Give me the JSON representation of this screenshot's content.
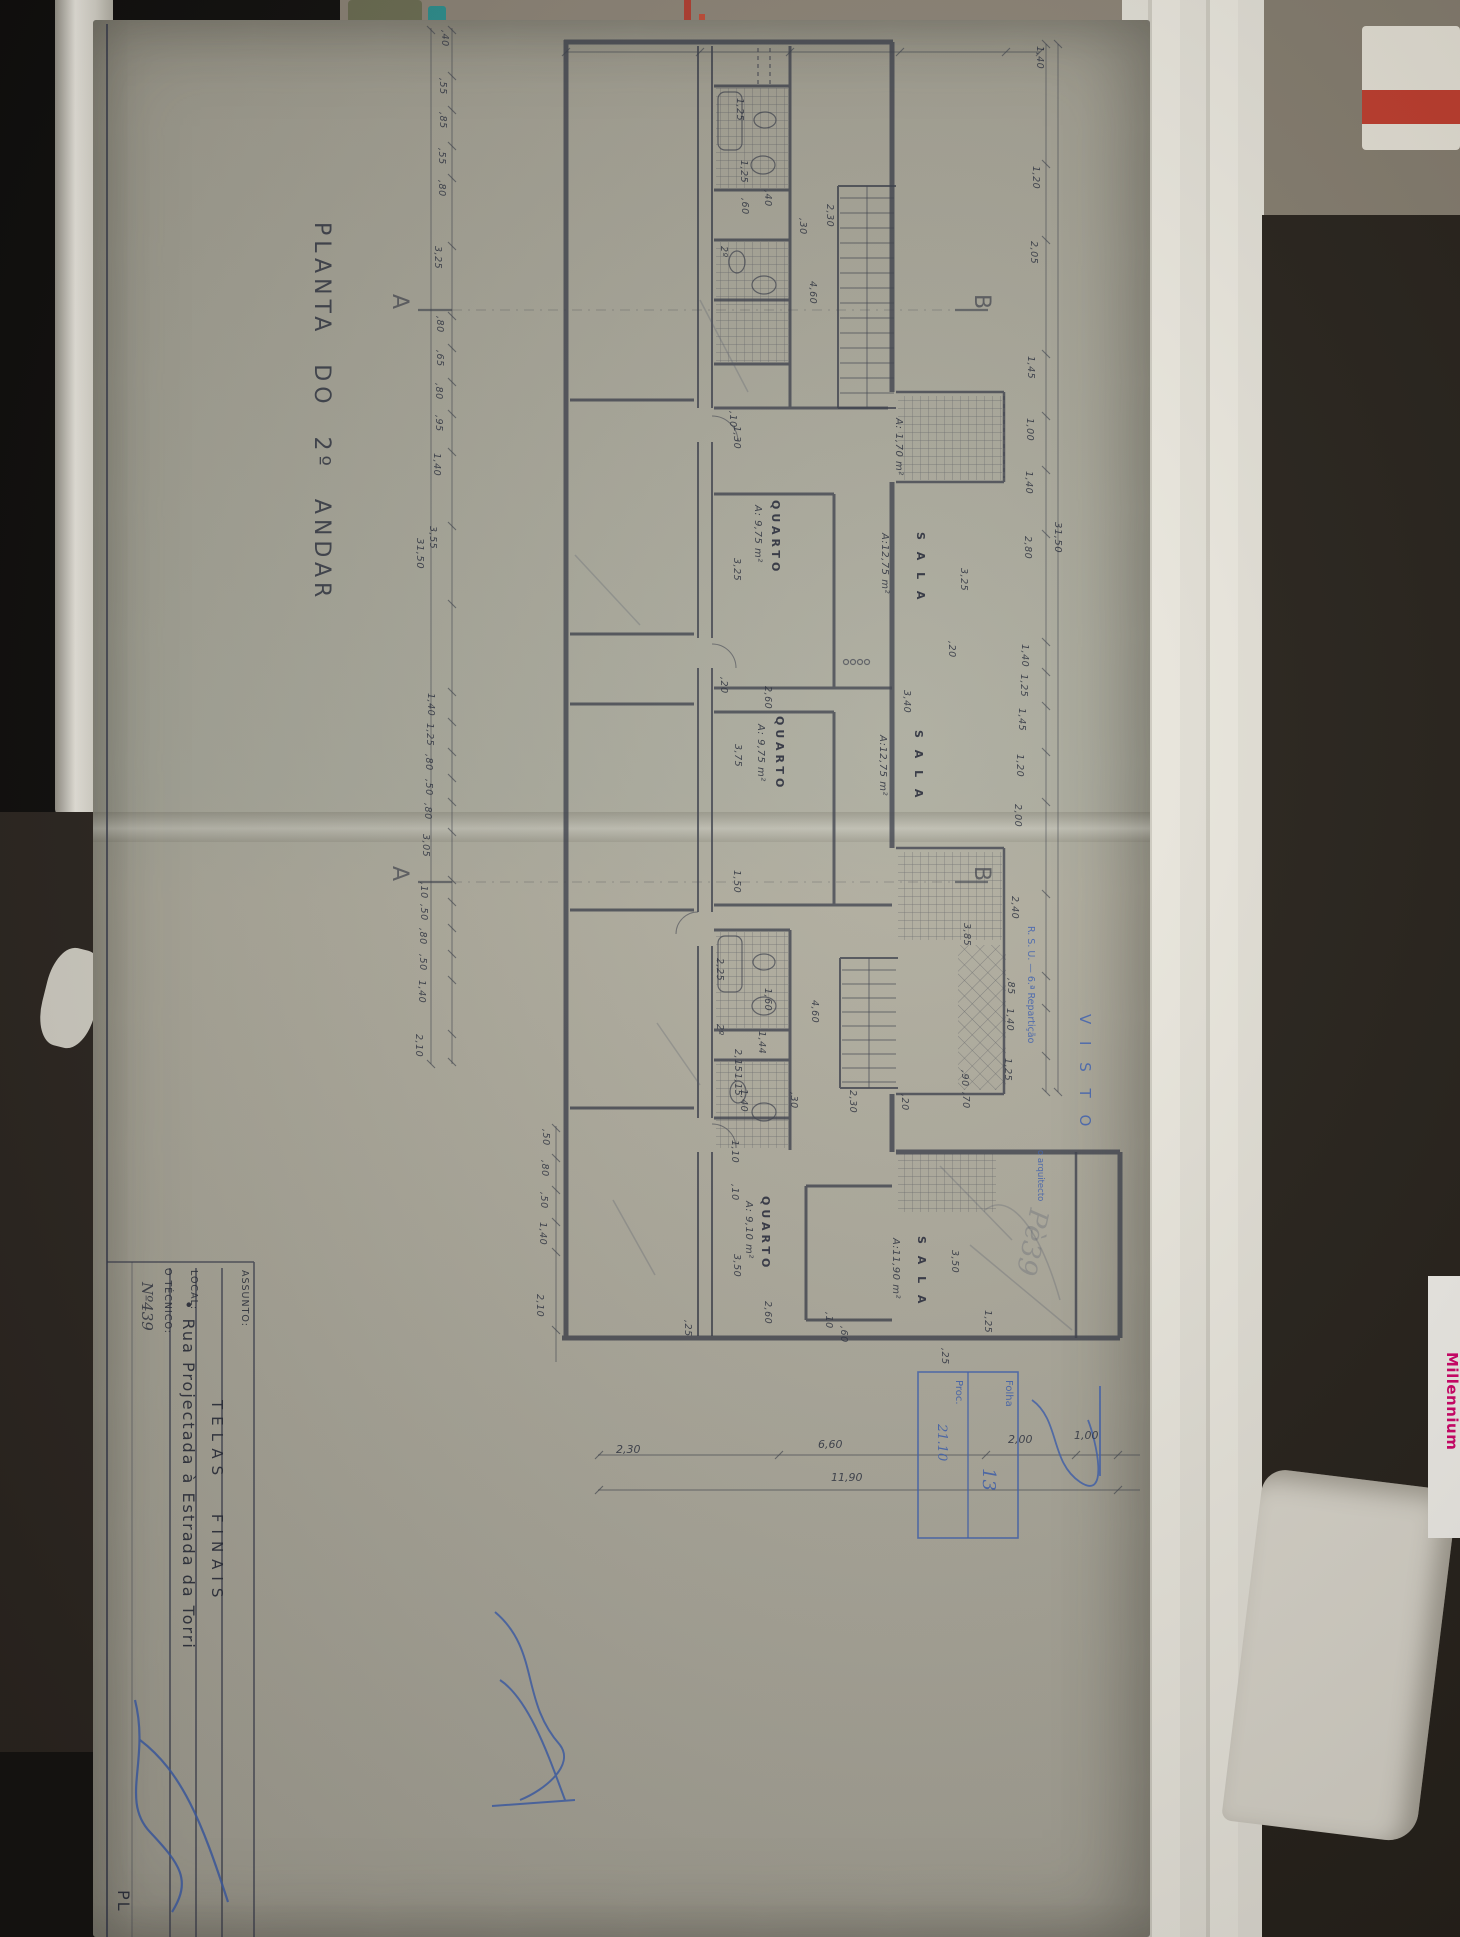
{
  "photo": {
    "millennium_text": "Millennium",
    "colors": {
      "paper": "#aba89b",
      "ink": "#3a3e4a",
      "stamp_blue": "#3f62ae",
      "brand_pink": "#d4006a"
    }
  },
  "drawing_title": "PLANTA DO 2º ANDAR",
  "title_block": {
    "assunto_label": "ASSUNTO:",
    "assunto_value": "TELAS FINAIS",
    "local_label": "LOCAL:",
    "local_value": "• Rua Projectada à Estrada da Torri",
    "tecnico_label": "O TÉCNICO:",
    "tecnico_value": "Nº439",
    "next_cell_partial": "PL"
  },
  "stamps": {
    "folha_label": "Folha",
    "folha_value": "13",
    "proc_label": "Proc.",
    "proc_value": "21.10",
    "visto_line1": "R. S. U. — 6.ª Repartição",
    "visto_line2": "V I S T O",
    "visto_line3": "o arquitecto",
    "pencil_note": "Pè39"
  },
  "plan": {
    "labels": [
      {
        "t": "QUARTO",
        "x": 781,
        "y": 500,
        "c": "room"
      },
      {
        "t": "A: 9,75 m²",
        "x": 762,
        "y": 505,
        "c": "area"
      },
      {
        "t": "S A L A",
        "x": 926,
        "y": 532,
        "c": "room"
      },
      {
        "t": "A:12,75 m²",
        "x": 889,
        "y": 533,
        "c": "area"
      },
      {
        "t": "QUARTO",
        "x": 785,
        "y": 716,
        "c": "room"
      },
      {
        "t": "A: 9,75 m²",
        "x": 765,
        "y": 724,
        "c": "area"
      },
      {
        "t": "S A L A",
        "x": 924,
        "y": 730,
        "c": "room"
      },
      {
        "t": "A:12,75 m²",
        "x": 887,
        "y": 735,
        "c": "area"
      },
      {
        "t": "QUARTO",
        "x": 771,
        "y": 1196,
        "c": "room"
      },
      {
        "t": "A: 9,10 m²",
        "x": 753,
        "y": 1201,
        "c": "area"
      },
      {
        "t": "S A L A",
        "x": 927,
        "y": 1236,
        "c": "room"
      },
      {
        "t": "A:11,90 m²",
        "x": 900,
        "y": 1238,
        "c": "area"
      },
      {
        "t": "A: 1,70 m²",
        "x": 903,
        "y": 418,
        "c": "area"
      },
      {
        "t": "A",
        "x": 410,
        "y": 294,
        "c": "sect"
      },
      {
        "t": "A",
        "x": 410,
        "y": 866,
        "c": "sect"
      },
      {
        "t": "B",
        "x": 992,
        "y": 294,
        "c": "sect"
      },
      {
        "t": "B",
        "x": 992,
        "y": 866,
        "c": "sect"
      },
      {
        "t": "1,25",
        "x": 744,
        "y": 98
      },
      {
        "t": ",60",
        "x": 749,
        "y": 198
      },
      {
        "t": ",40",
        "x": 772,
        "y": 190
      },
      {
        "t": "2º",
        "x": 728,
        "y": 246
      },
      {
        "t": "1,25",
        "x": 748,
        "y": 160
      },
      {
        "t": "2,30",
        "x": 834,
        "y": 204
      },
      {
        "t": ",30",
        "x": 807,
        "y": 218
      },
      {
        "t": "4,60",
        "x": 817,
        "y": 281
      },
      {
        "t": ",10",
        "x": 737,
        "y": 411
      },
      {
        "t": "1,30",
        "x": 741,
        "y": 426
      },
      {
        "t": "3,25",
        "x": 741,
        "y": 558
      },
      {
        "t": "2,60",
        "x": 772,
        "y": 686
      },
      {
        "t": ",20",
        "x": 728,
        "y": 677
      },
      {
        "t": "3,40",
        "x": 911,
        "y": 690
      },
      {
        "t": "3,25",
        "x": 968,
        "y": 568
      },
      {
        "t": ",20",
        "x": 956,
        "y": 641
      },
      {
        "t": "3,75",
        "x": 742,
        "y": 744
      },
      {
        "t": "1,50",
        "x": 741,
        "y": 870
      },
      {
        "t": "3,85",
        "x": 971,
        "y": 923
      },
      {
        "t": "2,25",
        "x": 724,
        "y": 958
      },
      {
        "t": "1,60",
        "x": 772,
        "y": 988
      },
      {
        "t": "1,44",
        "x": 766,
        "y": 1031
      },
      {
        "t": "2º",
        "x": 724,
        "y": 1024
      },
      {
        "t": "2,15",
        "x": 742,
        "y": 1049
      },
      {
        "t": "1,15",
        "x": 742,
        "y": 1073
      },
      {
        "t": "1,40",
        "x": 748,
        "y": 1089
      },
      {
        "t": "4,60",
        "x": 819,
        "y": 1000
      },
      {
        "t": "2,30",
        "x": 857,
        "y": 1090
      },
      {
        "t": ",30",
        "x": 798,
        "y": 1092
      },
      {
        "t": ",20",
        "x": 909,
        "y": 1094
      },
      {
        "t": ",90",
        "x": 969,
        "y": 1070
      },
      {
        "t": ",70",
        "x": 970,
        "y": 1092
      },
      {
        "t": "1,10",
        "x": 739,
        "y": 1140
      },
      {
        "t": ",10",
        "x": 739,
        "y": 1184
      },
      {
        "t": "3,50",
        "x": 741,
        "y": 1254
      },
      {
        "t": "2,60",
        "x": 772,
        "y": 1301
      },
      {
        "t": ",25",
        "x": 692,
        "y": 1320
      },
      {
        "t": ",10",
        "x": 833,
        "y": 1312
      },
      {
        "t": ",60",
        "x": 848,
        "y": 1326
      },
      {
        "t": "3,50",
        "x": 959,
        "y": 1250
      },
      {
        "t": "1,25",
        "x": 992,
        "y": 1310
      },
      {
        "t": ",25",
        "x": 949,
        "y": 1348
      },
      {
        "t": ",40",
        "x": 449,
        "y": 30
      },
      {
        "t": ",55",
        "x": 447,
        "y": 78
      },
      {
        "t": ",85",
        "x": 447,
        "y": 112
      },
      {
        "t": ",55",
        "x": 446,
        "y": 148
      },
      {
        "t": ",80",
        "x": 446,
        "y": 180
      },
      {
        "t": "3,25",
        "x": 442,
        "y": 246
      },
      {
        "t": ",80",
        "x": 444,
        "y": 316
      },
      {
        "t": ",65",
        "x": 444,
        "y": 350
      },
      {
        "t": ",80",
        "x": 443,
        "y": 383
      },
      {
        "t": ",95",
        "x": 443,
        "y": 415
      },
      {
        "t": "1,40",
        "x": 441,
        "y": 453
      },
      {
        "t": "3,55",
        "x": 437,
        "y": 526
      },
      {
        "t": "31,50",
        "x": 424,
        "y": 538,
        "s": 10
      },
      {
        "t": "1,40",
        "x": 435,
        "y": 693
      },
      {
        "t": "1,25",
        "x": 434,
        "y": 723
      },
      {
        "t": ",80",
        "x": 433,
        "y": 754
      },
      {
        "t": ",50",
        "x": 433,
        "y": 779
      },
      {
        "t": ",80",
        "x": 432,
        "y": 803
      },
      {
        "t": "3,05",
        "x": 430,
        "y": 834
      },
      {
        "t": ",10",
        "x": 428,
        "y": 882
      },
      {
        "t": ",50",
        "x": 428,
        "y": 904
      },
      {
        "t": ",80",
        "x": 427,
        "y": 928
      },
      {
        "t": ",50",
        "x": 427,
        "y": 954
      },
      {
        "t": "1,40",
        "x": 426,
        "y": 980
      },
      {
        "t": "2,10",
        "x": 423,
        "y": 1034
      },
      {
        "t": "1,40",
        "x": 1044,
        "y": 46
      },
      {
        "t": "1,20",
        "x": 1040,
        "y": 166
      },
      {
        "t": "2,05",
        "x": 1038,
        "y": 241
      },
      {
        "t": "1,45",
        "x": 1035,
        "y": 356
      },
      {
        "t": "1,00",
        "x": 1034,
        "y": 418
      },
      {
        "t": "1,40",
        "x": 1033,
        "y": 471
      },
      {
        "t": "2,80",
        "x": 1032,
        "y": 536
      },
      {
        "t": "31,50",
        "x": 1062,
        "y": 522,
        "s": 10
      },
      {
        "t": "1,40",
        "x": 1029,
        "y": 644
      },
      {
        "t": "1,25",
        "x": 1028,
        "y": 674
      },
      {
        "t": "1,45",
        "x": 1026,
        "y": 708
      },
      {
        "t": "1,20",
        "x": 1024,
        "y": 754
      },
      {
        "t": "2,00",
        "x": 1022,
        "y": 804
      },
      {
        "t": "2,40",
        "x": 1019,
        "y": 896
      },
      {
        "t": ",85",
        "x": 1015,
        "y": 978
      },
      {
        "t": "1,40",
        "x": 1014,
        "y": 1008
      },
      {
        "t": "1,25",
        "x": 1012,
        "y": 1058
      },
      {
        "t": ",50",
        "x": 550,
        "y": 1129
      },
      {
        "t": ",80",
        "x": 549,
        "y": 1160
      },
      {
        "t": ",50",
        "x": 548,
        "y": 1192
      },
      {
        "t": "1,40",
        "x": 547,
        "y": 1222
      },
      {
        "t": "2,10",
        "x": 544,
        "y": 1294
      },
      {
        "t": "2,30",
        "x": 616,
        "y": 1444,
        "c": "dimh",
        "u": 1
      },
      {
        "t": "6,60",
        "x": 818,
        "y": 1439,
        "c": "dimh",
        "u": 1
      },
      {
        "t": "2,00",
        "x": 1008,
        "y": 1434,
        "c": "dimh",
        "u": 1
      },
      {
        "t": "1,00",
        "x": 1074,
        "y": 1430,
        "c": "dimh",
        "u": 1
      },
      {
        "t": "11,90",
        "x": 831,
        "y": 1472,
        "c": "dimh",
        "u": 1
      }
    ]
  }
}
